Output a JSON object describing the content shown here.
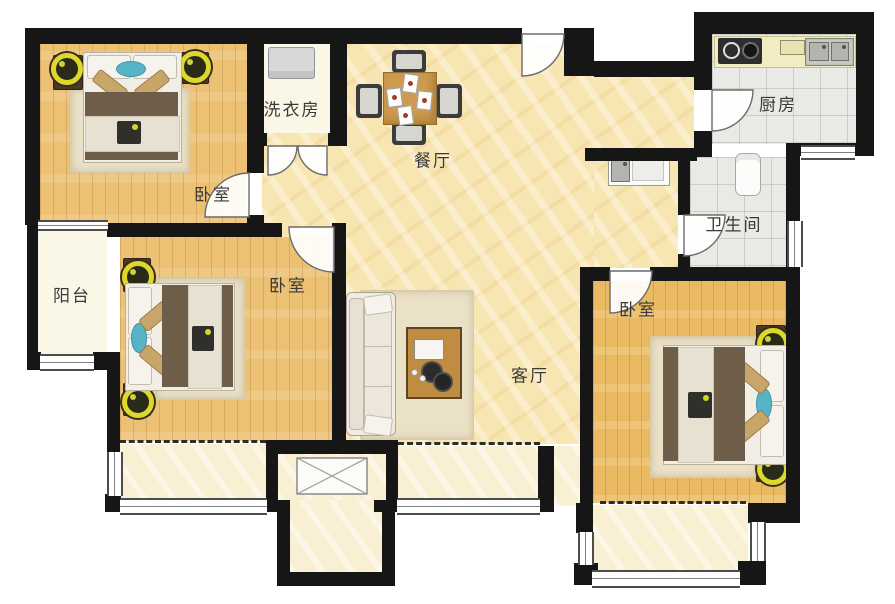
{
  "floorplan": {
    "rooms": {
      "bedroom_top_left": {
        "label": "卧室"
      },
      "bedroom_mid_left": {
        "label": "卧室"
      },
      "bedroom_right": {
        "label": "卧室"
      },
      "laundry": {
        "label": "洗衣房"
      },
      "dining": {
        "label": "餐厅"
      },
      "kitchen": {
        "label": "厨房"
      },
      "bathroom": {
        "label": "卫生间"
      },
      "balcony": {
        "label": "阳台"
      },
      "living": {
        "label": "客厅"
      }
    },
    "furniture_icons": [
      "double-bed-icon",
      "nightstand-lamp-icon",
      "sofa-icon",
      "coffee-table-icon",
      "dining-table-icon",
      "chair-icon",
      "washing-machine-icon",
      "stove-icon",
      "double-sink-icon",
      "vanity-sink-icon",
      "toilet-icon",
      "flue-shaft-icon"
    ],
    "colors": {
      "wall": "#161616",
      "wood_floor": "#ecc173",
      "marble_floor": "#f7e5b2",
      "tile_floor": "#e9e9e5",
      "balcony_floor": "#fbf7e7",
      "lamp_accent": "#dcd92b",
      "teal_accent": "#57b3c8",
      "blanket_brown": "#6e5e49",
      "label_text": "#3a3a3a"
    }
  }
}
